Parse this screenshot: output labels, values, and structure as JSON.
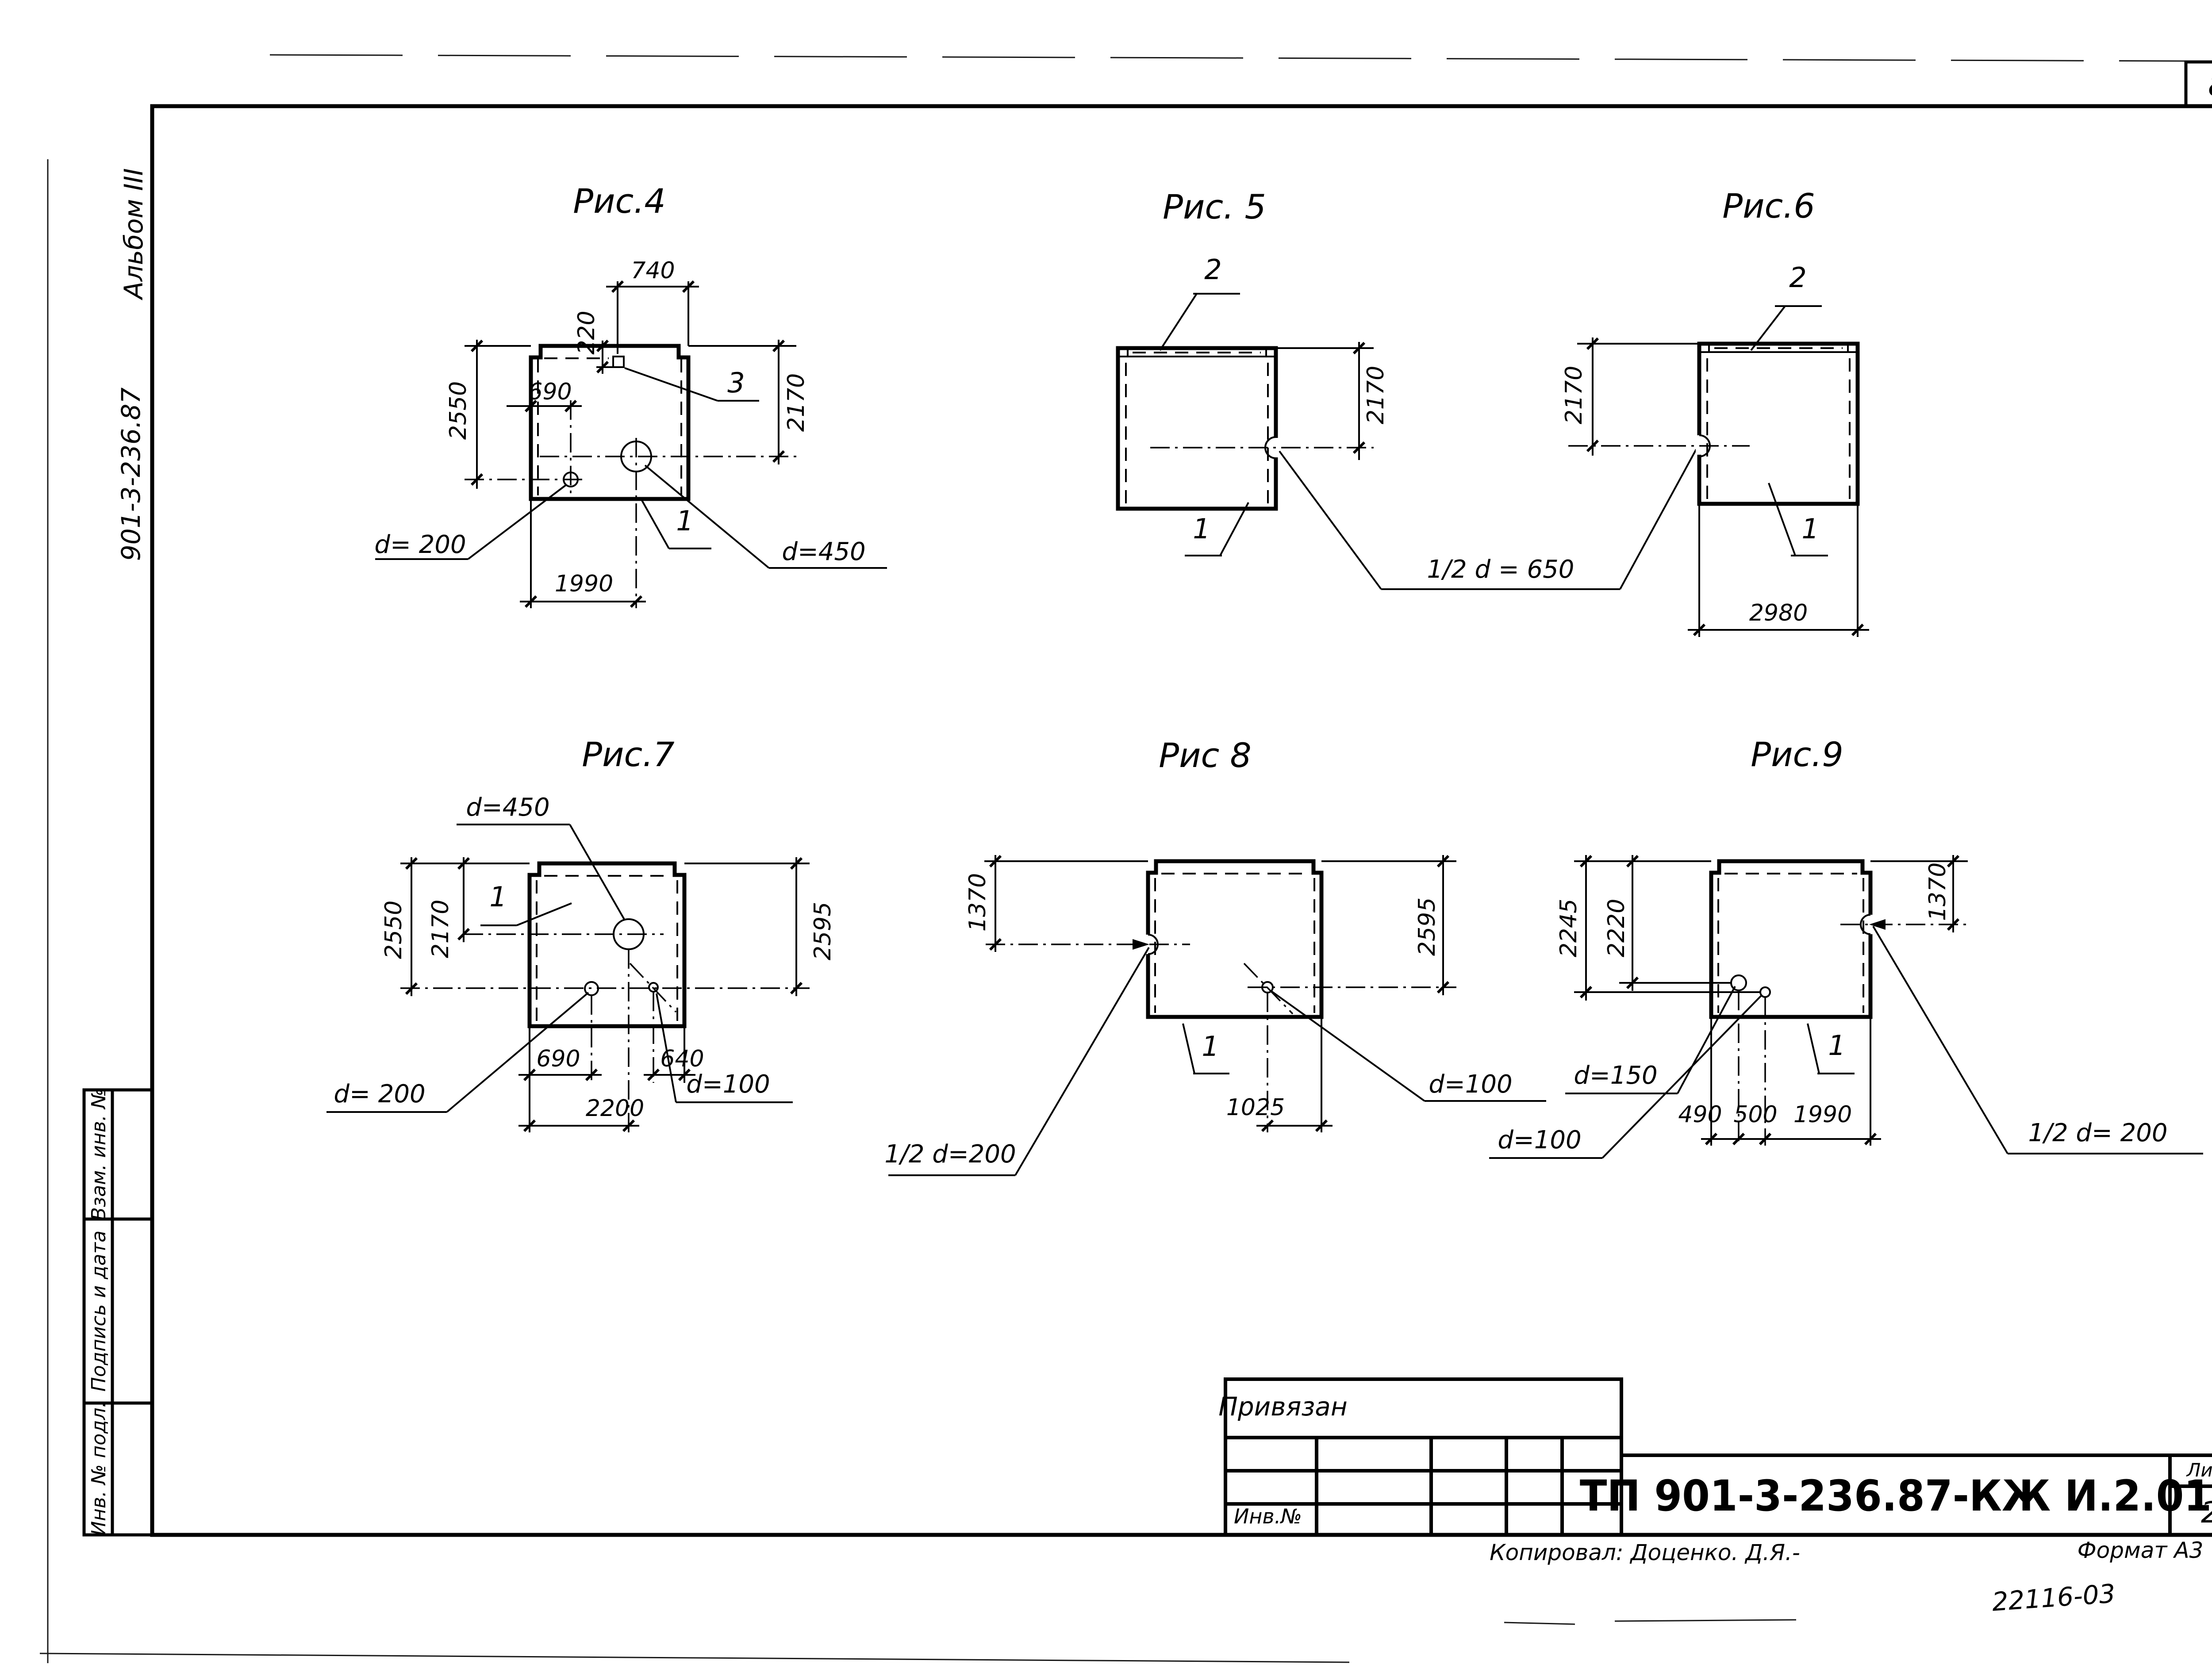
{
  "sheet": {
    "page_number": "8",
    "margin": {
      "album": "Альбом III",
      "doc_number": "901-3-236.87",
      "stamp_rows": [
        "Взам. инв. №",
        "Подпись и дата",
        "Инв. № подл."
      ]
    },
    "title_block": {
      "note": "Привязан",
      "inv_label": "Инв.№",
      "designation": "ТП 901-3-236.87-КЖ И.2.01",
      "sheet_label": "Лист",
      "sheet_number": "2",
      "copied_by": "Копировал: Доценко. Д.Я.-",
      "format": "Формат А3",
      "stamp_code": "22116-03"
    }
  },
  "figures": {
    "fig4": {
      "title": "Рис.4",
      "dims": {
        "w740": "740",
        "h220": "220",
        "h2550": "2550",
        "w690": "690",
        "h2170": "2170",
        "w1990": "1990"
      },
      "labels": {
        "pos1": "1",
        "pos3": "3",
        "d450": "d=450",
        "d200": "d= 200"
      }
    },
    "fig5": {
      "title": "Рис. 5",
      "dims": {
        "h2170": "2170"
      },
      "labels": {
        "pos1": "1",
        "pos2": "2",
        "half_d650": "1/2 d = 650"
      }
    },
    "fig6": {
      "title": "Рис.6",
      "dims": {
        "h2170": "2170",
        "w2980": "2980"
      },
      "labels": {
        "pos1": "1",
        "pos2": "2"
      }
    },
    "fig7": {
      "title": "Рис.7",
      "dims": {
        "h2550": "2550",
        "h2170": "2170",
        "h2595": "2595",
        "w690": "690",
        "w640": "640",
        "w2200": "2200"
      },
      "labels": {
        "pos1": "1",
        "d450": "d=450",
        "d200": "d= 200",
        "d100": "d=100"
      }
    },
    "fig8": {
      "title": "Рис 8",
      "dims": {
        "h1370": "1370",
        "h2595": "2595",
        "w1025": "1025"
      },
      "labels": {
        "pos1": "1",
        "half_d200": "1/2 d=200",
        "d100": "d=100"
      }
    },
    "fig9": {
      "title": "Рис.9",
      "dims": {
        "h2245": "2245",
        "h2220": "2220",
        "h1370": "1370",
        "w490": "490",
        "w500": "500",
        "w1990": "1990"
      },
      "labels": {
        "pos1": "1",
        "d150": "d=150",
        "d100": "d=100",
        "half_d200": "1/2 d= 200"
      }
    }
  }
}
